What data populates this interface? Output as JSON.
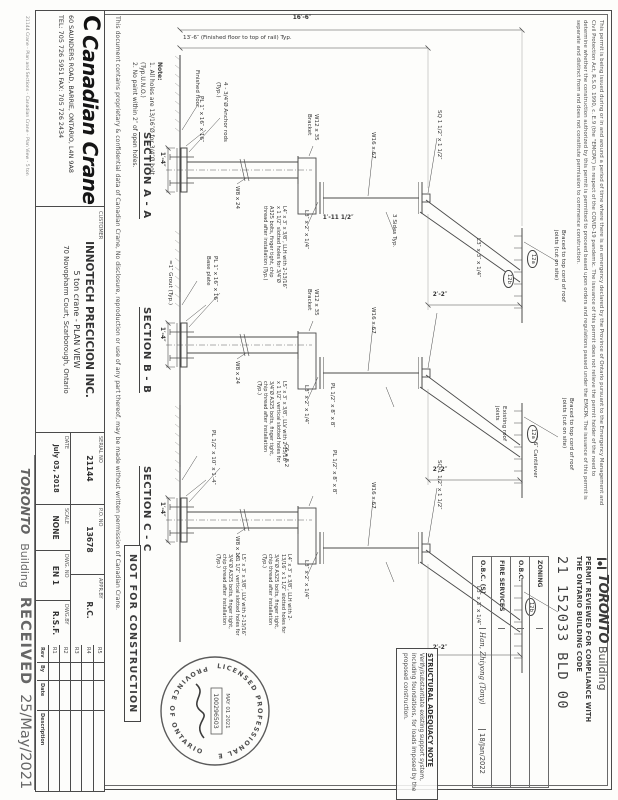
{
  "page": {
    "permit_disclaimer": {
      "line1": "This permit is being issued during or in and around a period of time where there is an emergency declared by the Province of Ontario pursuant to the Emergency Management and",
      "line2": "Civil Protection Act, R.S.O. 1990, c. E.9 (the “EMCPA”) in respect of the COVID-19 pandemic.  The issuance of this permit does not relieve the permit holder of the need to",
      "line3": "determine whether the construction authorized by this permit is permitted to proceed based upon orders and regulations passed under the EMCPA.  The issuance of this permit is",
      "line4": "separate and distinct from and does not constitute permission to commence construction."
    },
    "toronto_stamp": {
      "logo_text": "TORONTO",
      "logo_sub": "Building",
      "review_line1": "PERMIT REVIEWED FOR COMPLIANCE WITH",
      "review_line2": "THE ONTARIO BUILDING CODE",
      "permit_number": "21 152033 BLD 00",
      "rows": [
        {
          "label": "ZONING",
          "sign": "",
          "date": ""
        },
        {
          "label": "O.B.C.",
          "sign": "",
          "date": ""
        },
        {
          "label": "FIRE SERVICES",
          "sign": "",
          "date": ""
        },
        {
          "label": "O.B.C. (S)",
          "sign": "Han, Zhiyong (Tony)",
          "date": "18/Jan/2022"
        }
      ]
    },
    "structural_note": {
      "title": "STRUCTURAL ADEQUACY NOTE",
      "body": "Verify/substantiate existing support system, including foundations, for loads imposed by the proposed construction."
    },
    "seal": {
      "arc_top": "LICENSED PROFESSIONAL ENGINEER",
      "arc_bottom": "PROVINCE OF ONTARIO",
      "number": "100296503",
      "date": "MAY 01 2021"
    },
    "not_for_construction": "NOT FOR CONSTRUCTION",
    "received_stamp": {
      "logo_text": "TORONTO",
      "logo_sub": "Building",
      "status": "RECEIVED",
      "date": "25/May/2021"
    },
    "notes": {
      "title": "Note:",
      "item1": "1. All holes are 13/16″Ø for 3/4″Ø bolt (Typ.U.N.O.)",
      "item2": "2. No paint within 2″ of open holes."
    },
    "confidentiality": "This document contains proprietary & confidential data of Canadian Crane, No disclosure, reproduction or use of any part thereof, may be made without written permission of Canadian Crane.",
    "section_titles": {
      "a": "SECTION A - A",
      "b": "SECTION B - B",
      "c": "SECTION C - C"
    },
    "title_block": {
      "company_name": "Canadian Crane",
      "address1": "60 SAUNDERS ROAD, BARRIE, ONTARIO, L4N 9A8",
      "address2": "TEL:  705 726 5951  FAX: 705 726 2434",
      "customer_label": "CUSTOMER",
      "customer_name": "INNOTECH PRECICION INC.",
      "customer_desc": "5 ton crane - PLAN VIEW",
      "customer_addr": "70 Novopharm Court, Scarborough, Ontario",
      "serial_label": "SERIAL NO",
      "serial_value": "21144",
      "po_label": "P.O. NO",
      "po_value": "13678",
      "appr_label": "APPR.BY",
      "appr_value": "R.C.",
      "date_label": "DATE",
      "date_value": "July 03, 2018",
      "scale_label": "SCALE",
      "scale_value": "NONE",
      "dwgno_label": "DWG. NO",
      "dwgno_value": "EN 1",
      "dwgby_label": "DWG.BY",
      "dwgby_value": "R.S.F."
    },
    "revision_table": {
      "revs": [
        "R5",
        "R4",
        "R3",
        "R2",
        "R1"
      ],
      "headers": [
        "Rev",
        "By",
        "Date",
        "Description"
      ]
    },
    "plot_line": "21144 Crane - Plan and Sections - Canadian Crane - Plan View - 5 ton",
    "annotations": {
      "dim_overall": "16′-6″",
      "dim_rail": "13′-6″  (Finished floor to top of rail) Typ.",
      "a_finished_floor": "Finished floor",
      "a_anchor_rods": "4 - 3/4″Ø Anchor rods (Typ.)",
      "a_base": "PL 1″ x 16″ x 16″",
      "a_base_dim": "1′-4″",
      "a_col": "W8 x 24",
      "a_bracket": "W12 x 35 Bracket",
      "a_beam": "W16 x 67",
      "a_rail": "SQ 1 1/2″ x 1 1/2″",
      "a_weld": "3 Sides Typ.",
      "a_dim_1115": "1′-11 1/2″",
      "a_angle": "L3″ x 2″ x 1/4″",
      "a_bolt_note": "L4″ x 3″ x 3/8″, LLH with 2-13/16″ x 1 1/2″ slotted holes for 3/4″Ø A325 bolts, finger tight, chip thread after installation (Typ.)",
      "a_brace": "L3″ x 3″ x 1/4″",
      "a_braced_roof": "Braced to top cord of roof joists (cut on site)",
      "a_dim_22": "2′-2″",
      "a_tag1": "12a",
      "a_tag2": "12b",
      "b_bracket": "W12 x 35 Bracket",
      "b_beam": "W16 x 67",
      "b_col": "W8 x 24",
      "b_base": "PL 1″ x 16″ x 16″ Base plate",
      "b_grout": "≈1″ Grout (Typ.)",
      "b_base_dim": "1′-4″",
      "b_plate": "PL 1/2″ x 8″ x 8″",
      "b_angle": "L3″ x 2″ x 1/4″",
      "b_bolt_note": "L5″ x 3″ x 3/8″, LLV with 2-13/16″ x 1 1/2″ vertical slotted holes for 3/4″Ø A325 bolts, finger tight, chip thread after installation (Typ.)",
      "b_braced_roof": "Braced to top cord of roof joists (cut on site)",
      "b_roof": "Existing roof joists",
      "b_cant": "2′-6″ Cantilever",
      "b_dim_22": "2′-2″",
      "b_tag": "12a",
      "c_col": "W8 x 18",
      "c_base": "PL 1/2″ x 10″ x 1′-4″",
      "c_base_dim": "1′-4″",
      "c_channel": "C6 x 8.2",
      "c_plate": "PL 1/2″ x 8″ x 8″",
      "c_beam": "W16 x 67",
      "c_rail": "SQ 1 1/2″ x 1 1/2″",
      "c_angle": "L3″ x 2″ x 1/4″",
      "c_brace": "L3″ x 3″ x 1/4″",
      "c_bolt_note_l4": "L4″ x 3″ x 3/8″, LLH with 2-13/16″ x 1 1/2″ slotted holes for 3/4″Ø A325 bolts, finger tight, chip thread after installation (Typ.)",
      "c_bolt_note_l5": "L5″ x 3″ x 3/8″, LLV with 2-13/16″ x 1 1/2″ vertical slotted holes for 3/4″Ø A325 bolts, finger tight, chip thread after installation (Typ.)",
      "c_dim_22": "2′-2″",
      "c_tag": "12b"
    }
  }
}
